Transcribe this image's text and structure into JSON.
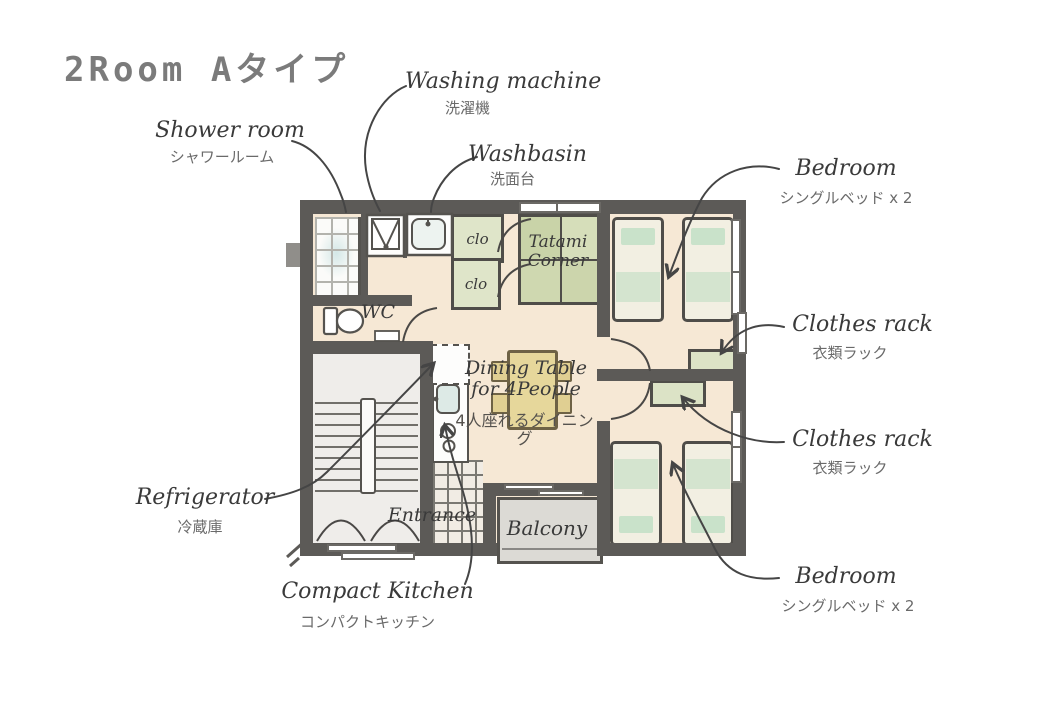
{
  "title": "2Room Aタイプ",
  "labels": {
    "shower_room": {
      "en": "Shower room",
      "jp": "シャワールーム"
    },
    "washing_machine": {
      "en": "Washing machine",
      "jp": "洗濯機"
    },
    "washbasin": {
      "en": "Washbasin",
      "jp": "洗面台"
    },
    "bedroom_top": {
      "en": "Bedroom",
      "jp": "シングルベッド x 2"
    },
    "clothes_rack_top": {
      "en": "Clothes rack",
      "jp": "衣類ラック"
    },
    "clothes_rack_bottom": {
      "en": "Clothes rack",
      "jp": "衣類ラック"
    },
    "bedroom_bottom": {
      "en": "Bedroom",
      "jp": "シングルベッド x 2"
    },
    "refrigerator": {
      "en": "Refrigerator",
      "jp": "冷蔵庫"
    },
    "compact_kitchen": {
      "en": "Compact Kitchen",
      "jp": "コンパクトキッチン"
    }
  },
  "plan": {
    "closet1": "clo",
    "closet2": "clo",
    "tatami": "Tatami Corner",
    "wc": "WC",
    "dining_en": "Dining Table for 4People",
    "dining_jp": "4人座れるダイニング",
    "entrance": "Entrance",
    "balcony": "Balcony"
  },
  "colors": {
    "wall": "#5c5a57",
    "floor": "#f6e8d5",
    "shower": "#fbfbf9",
    "tile_line": "#b3b3ad",
    "tatami_a": "#c9d3a8",
    "tatami_b": "#d6deba",
    "tatami_c": "#cfd8b0",
    "tatami_d": "#ccd5ac",
    "clo": "#dfe5c9",
    "rack": "#dce3c6",
    "bed": "#f2efe2",
    "pillow": "#c9e2ca",
    "blanket": "#d4e4cf",
    "table": "#e6d79b",
    "chair": "#e0cf92",
    "wood": "#6e6245",
    "balcony": "#dcdad5",
    "stairs": "#efedea",
    "entrance_tile": "#f1ece4",
    "line": "#454545",
    "outline": "#55534f",
    "window_frame": "#6b6965",
    "sink": "#ddeae6",
    "label": "#3a3a3a",
    "label_jp": "#6a6a6a",
    "title": "#7b7b7b"
  }
}
